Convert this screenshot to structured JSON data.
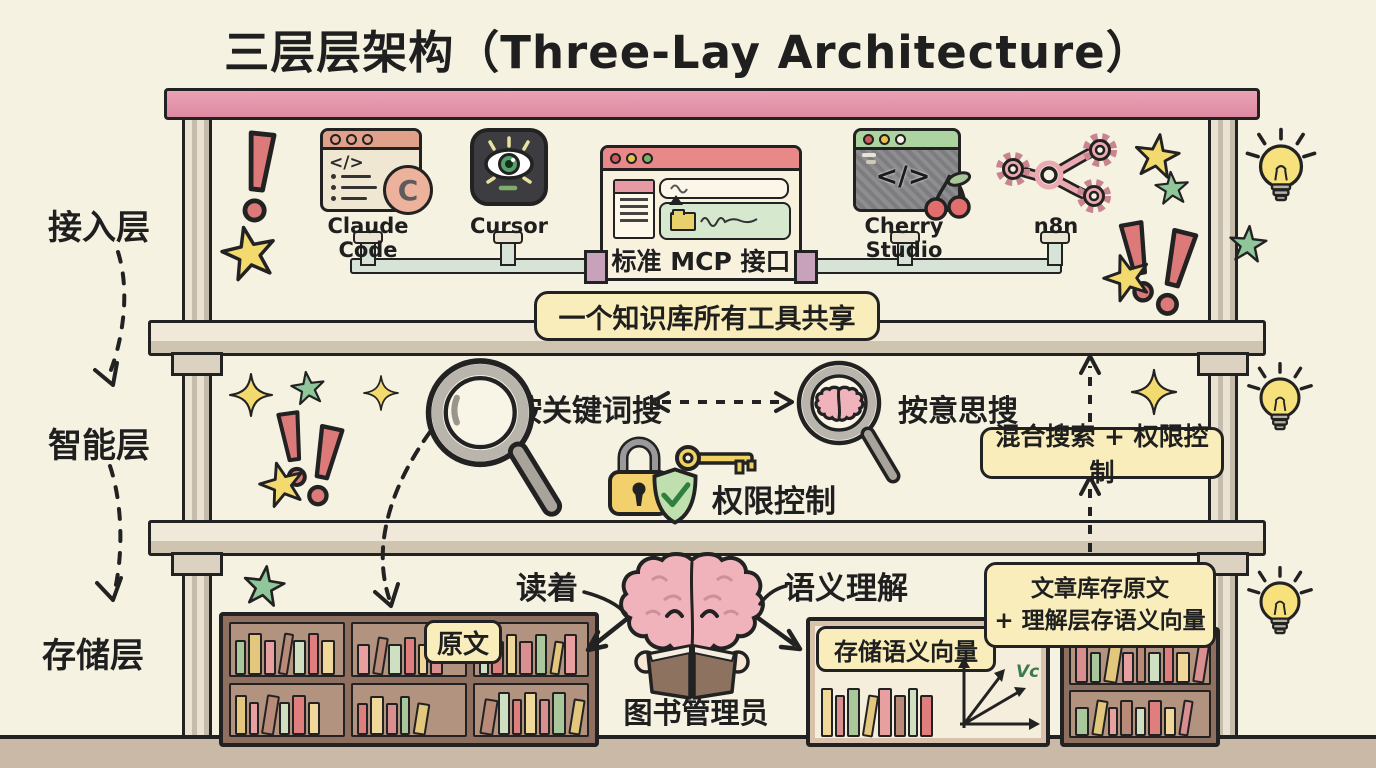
{
  "title": "三层层架构（Three-Lay Architecture）",
  "layer_labels": {
    "access": "接入层",
    "intelligence": "智能层",
    "storage": "存储层"
  },
  "access": {
    "tools": [
      {
        "label": "Claude Code"
      },
      {
        "label": "Cursor"
      },
      {
        "label": "标准 MCP 接口"
      },
      {
        "label": "Cherry Studio"
      },
      {
        "label": "n8n"
      }
    ],
    "banner": "一个知识库所有工具共享"
  },
  "intelligence": {
    "keyword_search": "按关键词搜",
    "meaning_search": "按意思搜",
    "permission": "权限控制",
    "hybrid": "混合搜索 + 权限控制"
  },
  "storage": {
    "reading": "读着",
    "semantic": "语义理解",
    "librarian": "图书管理员",
    "original": "原文",
    "vector_store": "存储语义向量",
    "vector_axis_label": "Vc",
    "note_line1": "文章库存原文",
    "note_line2": "+ 理解层存语义向量"
  },
  "glyphs": {
    "code": "</>",
    "claude_badge": "C"
  },
  "colors": {
    "background": "#f6f2e2",
    "ink": "#1f1f1f",
    "beam_pink": "#e295aa",
    "wood": "#e6dfcf",
    "highlight_yellow": "#f9eebb",
    "shelf_brown": "#8e6f60",
    "brain_pink": "#f0b3bc",
    "vector_label_green": "#3d7a4b",
    "book_palette": [
      "#d98f8f",
      "#a9c79a",
      "#e3c77c",
      "#e89f9f",
      "#b98a78",
      "#cfe0c2",
      "#e07d7d",
      "#f0d79a"
    ]
  }
}
